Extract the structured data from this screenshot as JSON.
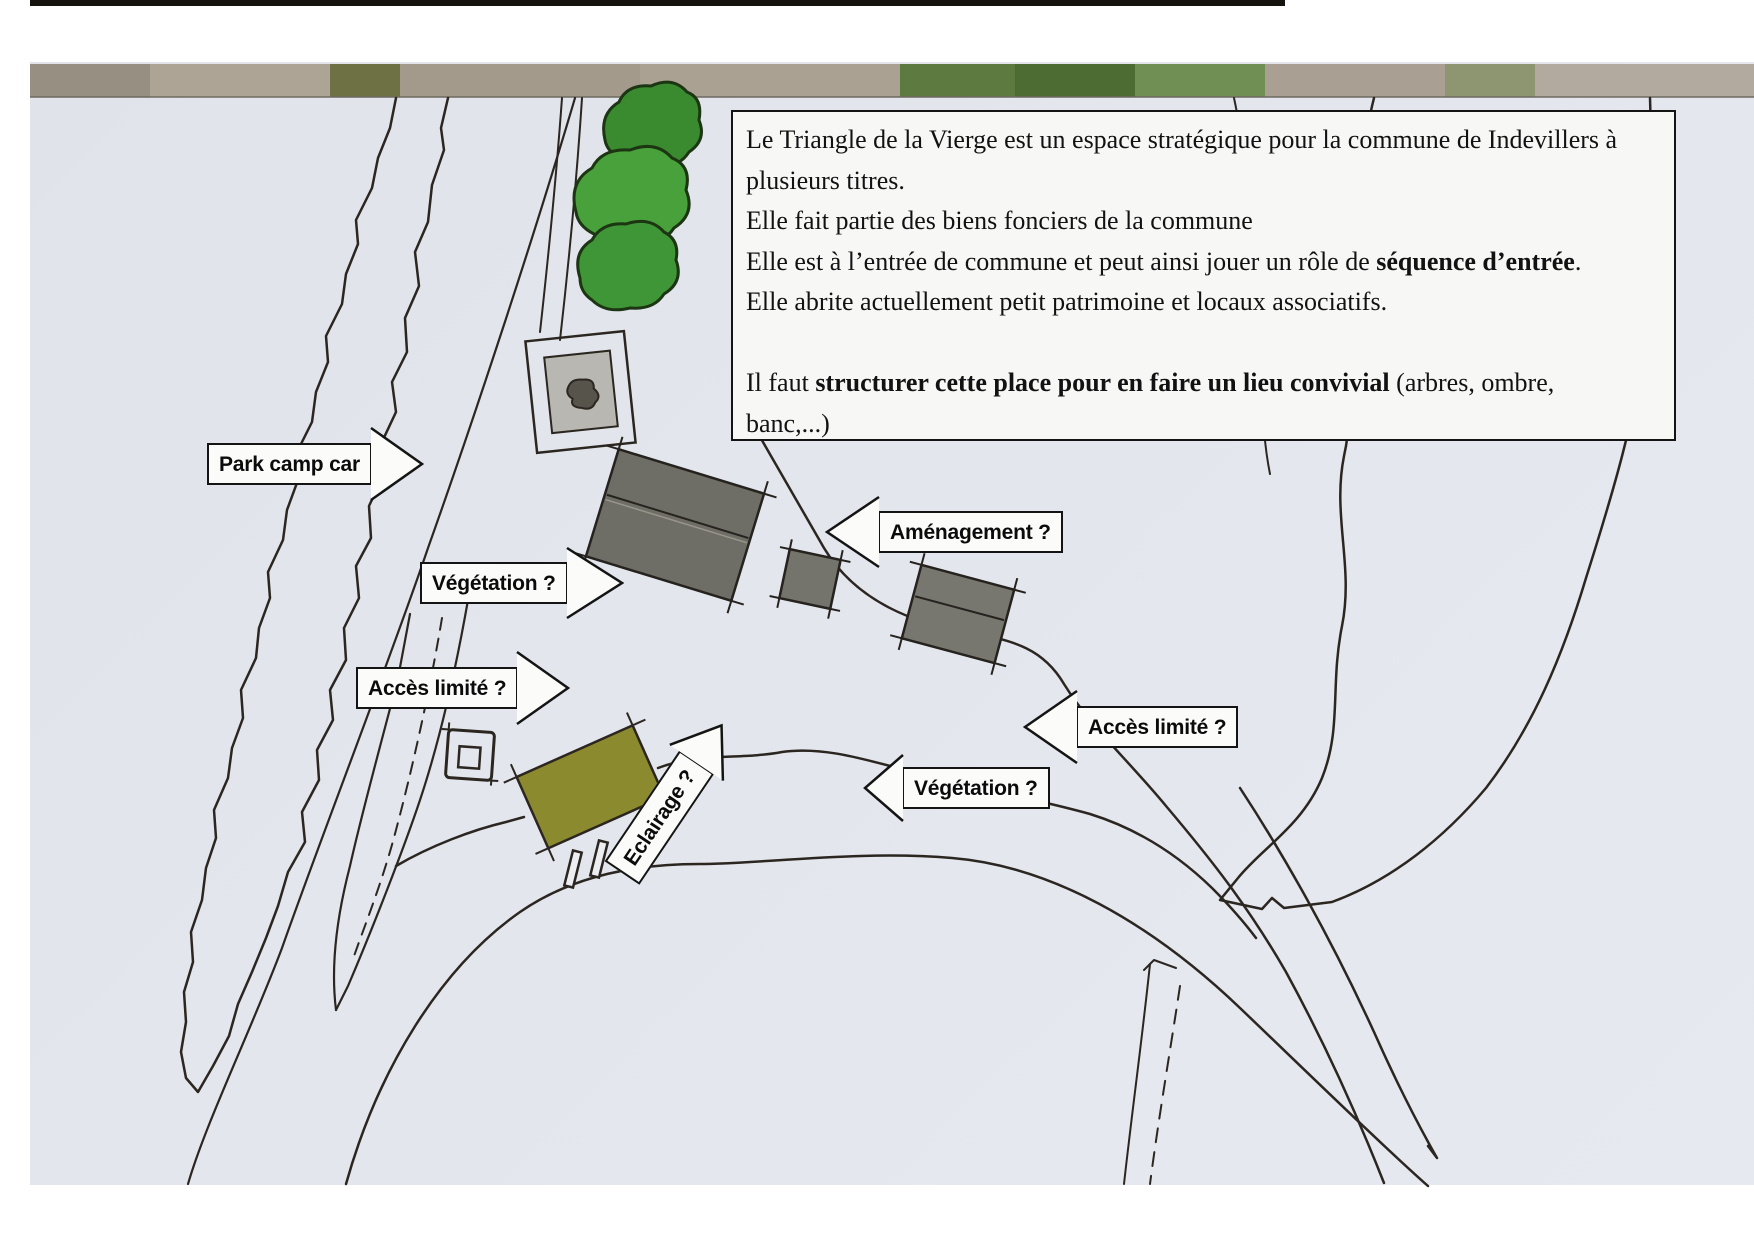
{
  "info_box": {
    "lines": [
      {
        "segments": [
          {
            "text": "Le Triangle de la Vierge est un espace stratégique pour la commune de Indevillers à",
            "bold": false
          }
        ]
      },
      {
        "segments": [
          {
            "text": "plusieurs titres.",
            "bold": false
          }
        ]
      },
      {
        "segments": [
          {
            "text": "Elle fait partie des biens fonciers de la commune",
            "bold": false
          }
        ]
      },
      {
        "segments": [
          {
            "text": "Elle est à l’entrée de commune et peut ainsi jouer un rôle de ",
            "bold": false
          },
          {
            "text": "séquence d’entrée",
            "bold": true
          },
          {
            "text": ".",
            "bold": false
          }
        ]
      },
      {
        "segments": [
          {
            "text": "Elle abrite actuellement petit patrimoine et locaux associatifs.",
            "bold": false
          }
        ]
      },
      {
        "segments": [
          {
            "text": "",
            "bold": false
          }
        ]
      },
      {
        "segments": [
          {
            "text": "Il faut ",
            "bold": false
          },
          {
            "text": "structurer cette place pour en faire un lieu convivial",
            "bold": true
          },
          {
            "text": " (arbres, ombre,",
            "bold": false
          }
        ]
      },
      {
        "segments": [
          {
            "text": "banc,...)",
            "bold": false
          }
        ]
      }
    ]
  },
  "labels": {
    "park_camp_car": "Park camp car",
    "vegetation_left": "Végétation ?",
    "acces_limite_left": "Accès limité ?",
    "amenagement": "Aménagement ?",
    "acces_limite_right": "Accès limité ?",
    "vegetation_right": "Végétation ?",
    "eclairage": "Eclairage ?"
  },
  "colors": {
    "paper": "#e4e6ee",
    "ink": "#2b2620",
    "tree_green_dark": "#3a8a2f",
    "tree_green_mid": "#49a13c",
    "tree_green_low": "#3f9636",
    "olive_building": "#8c8a2e",
    "building_gray": "#6e6d66",
    "chapel_inner_gray": "#b9b7b1",
    "label_bg": "#fbfbf9",
    "label_border": "#141414",
    "photo_strip_base": "#a59d90"
  }
}
